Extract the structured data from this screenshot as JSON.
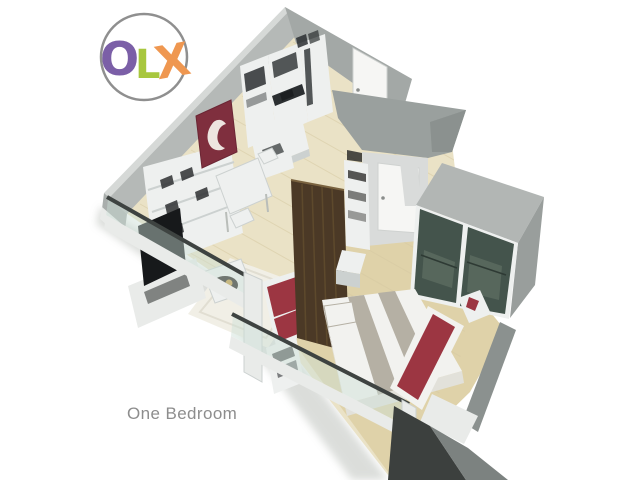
{
  "watermark": {
    "letters": [
      "O",
      "L",
      "X"
    ]
  },
  "caption": {
    "text": "One Bedroom"
  },
  "scene": {
    "description": "3D isometric cutaway render of a one-bedroom apartment floor plan",
    "rooms": [
      "kitchen",
      "living-dining",
      "bathroom",
      "bedroom",
      "wardrobe",
      "balcony"
    ]
  },
  "colors": {
    "bg": "#ffffff",
    "wall_top_highlight": "#d6d9d7",
    "wall_outer": "#b5b9b7",
    "wall_inner": "#a3a8a6",
    "wall_mid": "#9aa09e",
    "wall_dark": "#8b918f",
    "wall_deep": "#7c8280",
    "wall_shadow": "#3c403e",
    "wall_endcap": "#a9aeac",
    "floor_base": "#eae2c6",
    "floor_bedroom": "#dfd2a9",
    "plank": "#d6c9a2",
    "rug": "#f1efe6",
    "rug_edge": "#e1ded2",
    "white_furn": "#eef0ef",
    "furn_shadow": "#ccd1d0",
    "counter_dark": "#2b2f31",
    "tv_screen": "#17191b",
    "art_maroon": "#7f2f3e",
    "art_white": "#f3efe9",
    "wood_partition": "#4b3926",
    "wood_light": "#66512f",
    "door_white": "#f6f6f4",
    "door_edge": "#cfd2d0",
    "light_wall": "#d9dbda",
    "glass_closet": "#44544c",
    "glass_closet_light": "#5c6c60",
    "closet_top": "#b2b6b4",
    "closet_side": "#999e9c",
    "bed_white": "#f2f2ef",
    "bed_side": "#e2e1da",
    "bed_stripe": "#b5b0a4",
    "red_accent": "#9c3642",
    "railing_rail": "#3e4341",
    "railing_glass": "rgba(205,224,216,0.45)",
    "post_white": "#e9ebe9",
    "caption": "#8d8d8d",
    "gold": "#c49a3f",
    "logo_o": "#7b5fa7",
    "logo_l": "#a8c73e",
    "logo_x": "#ef9750",
    "logo_ring": "#8f8f8f"
  }
}
